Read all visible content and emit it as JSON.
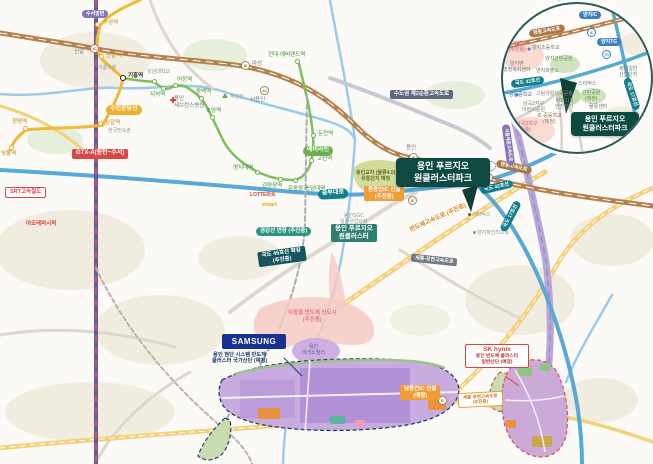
{
  "colors": {
    "brand_teal": "#0e4a42",
    "prugio_teal": "#2e7e72",
    "samsung_navy": "#17338f",
    "sk_red": "#d9453a",
    "road_teal": "#117e8a"
  },
  "ui": {
    "ic": "IC",
    "jc": "JC",
    "tg": "TG"
  },
  "rails": {
    "gtx_badge": "GTX-A(동탄~수서)",
    "gtx_dir": "수서방면",
    "srt_badge": "SRT고속철도",
    "bundang_badge": "수인분당선",
    "ever_badge": "에버라인",
    "gyeonggang_badge": "경강선 연장 (추진중)",
    "st_guseong": "구성역",
    "st_singal": "신갈역",
    "st_giheung": "기흥역",
    "st_sanggal": "상갈역",
    "st_cheongmyeong": "청명역",
    "st_yeongtong": "영통역",
    "st_gangnamdae": "강남대역",
    "st_jiseok": "지석역",
    "st_eojeong": "어정역",
    "st_dongbaek": "동백역",
    "st_chodang": "초당역",
    "st_myeongji": "명지대역",
    "st_gimnyangjang": "김량장역",
    "st_undongjang": "운동장·송담대역",
    "st_gojin": "고진역",
    "st_dunjeon": "둔전역",
    "st_jeondae": "전대·에버랜드역"
  },
  "roads": {
    "yeongdong": "영동고속도로",
    "jungbu": "중부대로",
    "r42": "국도 42호선",
    "r17": "국도 17호선",
    "r45_l1": "국도 45호선 확장",
    "r45_l2": "(추진중)",
    "semi": "반도체고속도로 (추진중)",
    "cap2": "수도권 제2순환고속도로",
    "sejong": "세종-포천고속도로",
    "seoulsejong": "서울세종고속도로",
    "sejong_s_l1": "세종-포천고속도로",
    "sejong_s_l2": "(추진중)",
    "dong_ic_l1": "동용인IC 신설",
    "dong_ic_l2": "(추진중)",
    "nam_ic_l1": "남용인IC 신설",
    "nam_ic_l2": "(예정)",
    "ic_singal": "신갈",
    "ic_maseong": "마성",
    "ic_seoyongin": "서용인",
    "ic_yongin": "용인",
    "ic_yangji": "양지IC"
  },
  "places": {
    "giheung_gu": "기흥구청",
    "gangnam_univ": "강남대학교",
    "severance_l1": "용인",
    "severance_l2": "세브란스병원",
    "folk": "한국민속촌",
    "amore": "아모레퍼시픽",
    "seokseong": "석성산",
    "lotte": "LOTTE마트",
    "emart": "emart",
    "starbucks": "스타벅스",
    "yangji_pine": "양지파인리조트",
    "sgc_l1": "용인SGC",
    "sgc_l2": "일반산업단지",
    "platform_l1": "용인교자 (물류4.0)",
    "platform_l2": "유통단지 예정"
  },
  "areas": {
    "idong_l1": "이동읍 반도체 신도시",
    "idong_l2": "(추진중)",
    "techno_l1": "용인",
    "techno_l2": "테크노밸리"
  },
  "project": {
    "main_l1": "용인 푸르지오",
    "main_l2": "원클러스터파크",
    "sub_l1": "용인 푸르지오",
    "sub_l2": "원클러스터"
  },
  "samsung": {
    "logo": "SAMSUNG",
    "l1": "용인 첨단 시스템 반도체",
    "l2": "클러스터 국가산단 (예정)"
  },
  "sk": {
    "logo": "SK hynix",
    "l1": "용인 반도체 클러스터",
    "l2": "일반산단 (예정)"
  },
  "inset": {
    "yangji_ic": "양지IC",
    "yangji_tg": "양지TG",
    "yeongdong": "영동고속도로",
    "r42": "국도 42호선",
    "r17": "국도 17호선",
    "seoulsejong": "서울세종고속도로",
    "yangji_district_l1": "양지지구",
    "yangji_district_l2": "(추진중)",
    "yangji_elem": "양지초등학교",
    "yangji_park": "양지근린공원",
    "yangji_office_l1": "양지면",
    "yangji_office_l2": "행정복지센터",
    "yangji_police": "양지파출소",
    "starbucks": "스타벅스",
    "jeil_l1": "제일일반",
    "jeil_l2": "산업단지",
    "yongdong_school": "용동중학교",
    "gorim_park": "고림생활체육공원",
    "y119_l1": "양지119",
    "y119_l2": "안전센터",
    "namgok_l1": "남곡2지구",
    "namgok_l2": "어린이공원",
    "school_plan_l1": "초·중등학교",
    "school_plan_l2": "(예정)",
    "dongmun_l1": "동문남곡2지구",
    "dongmun_l2": "(추진중)",
    "green_plan_l1": "근린공원",
    "green_plan_l2": "(예정)",
    "logistics": "물류센터",
    "badge_l1": "용인 푸르지오",
    "badge_l2": "원클러스터파크"
  }
}
